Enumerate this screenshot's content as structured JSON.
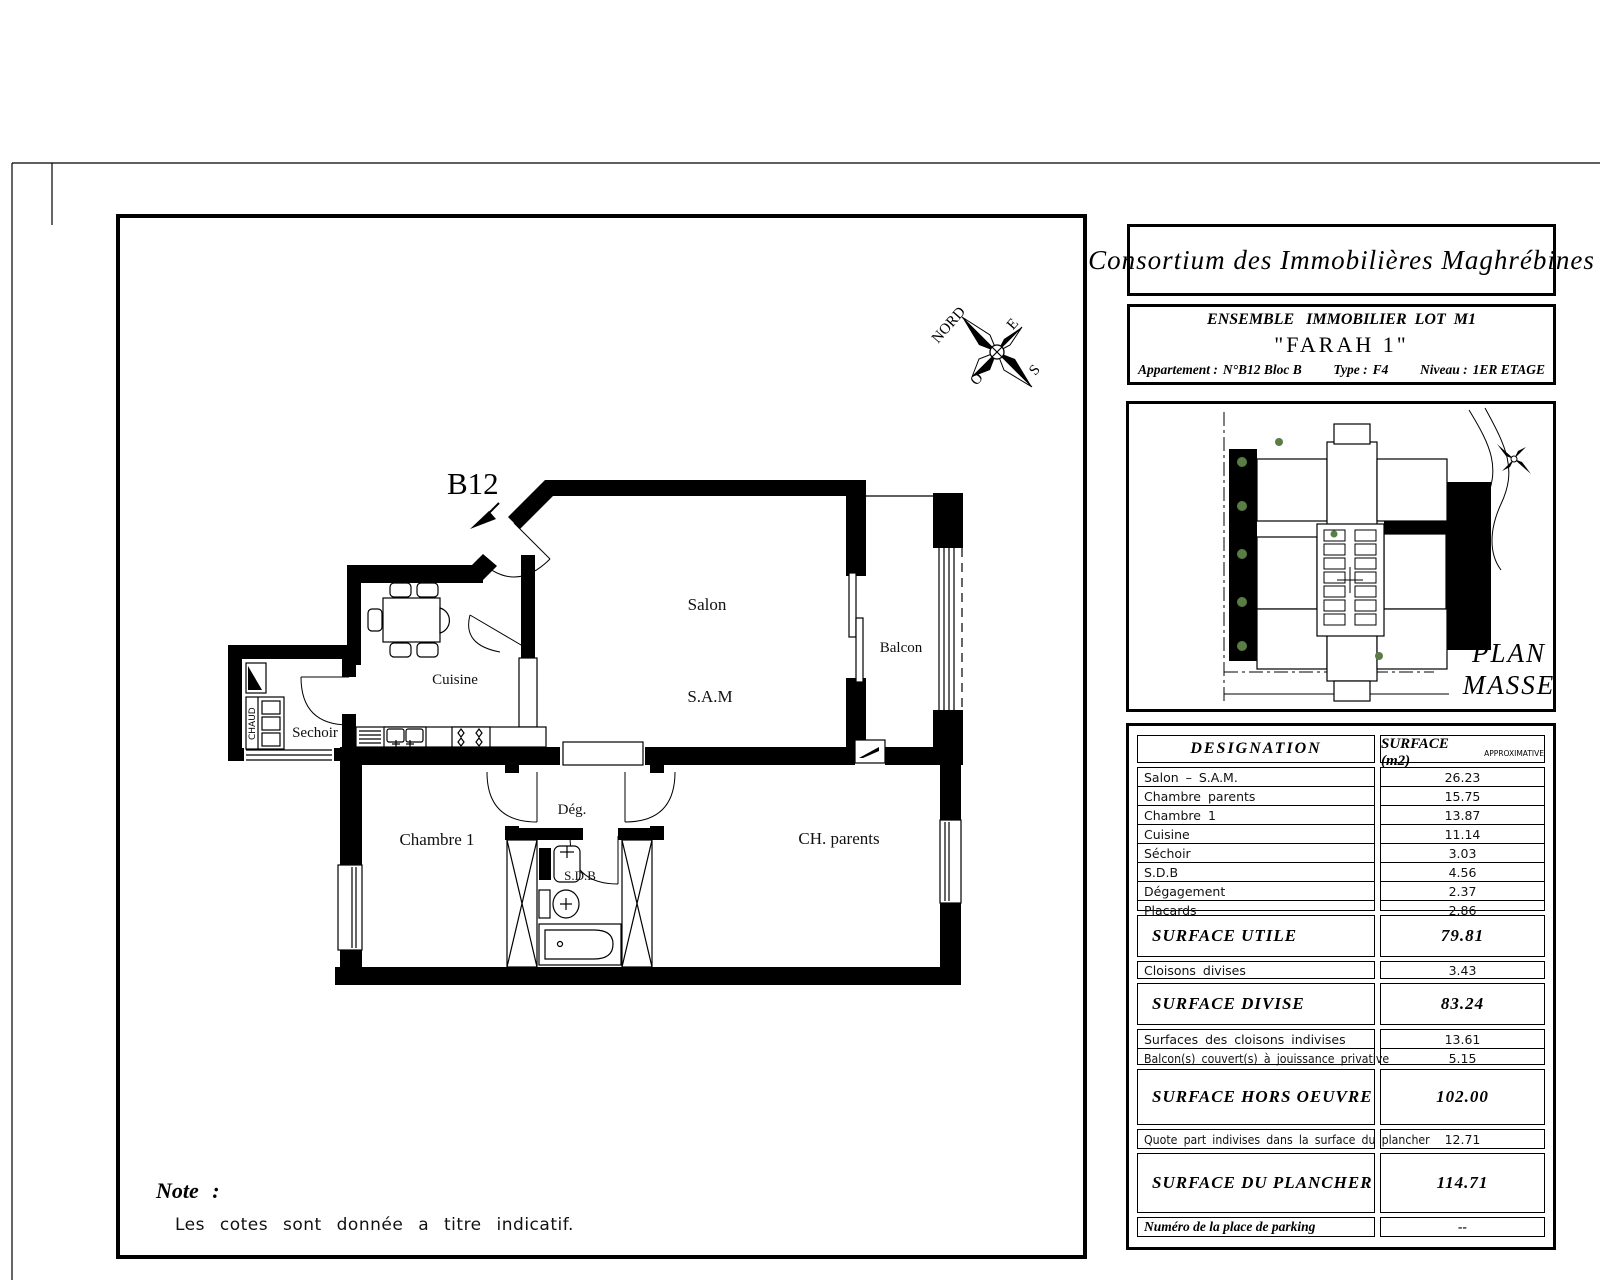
{
  "sheet": {
    "unit_label": "B12",
    "note": {
      "title": "Note :",
      "body": "Les cotes sont donnée a titre indicatif."
    },
    "compass": {
      "n": "NORD",
      "e": "E",
      "w": "O",
      "s": "S"
    },
    "rooms": {
      "salon": "Salon",
      "sam": "S.A.M",
      "balcon": "Balcon",
      "cuisine": "Cuisine",
      "sechoir": "Sechoir",
      "chambre1": "Chambre 1",
      "degagement": "Dég.",
      "sdb": "S.D.B",
      "ch_parents": "CH. parents",
      "chaud": "CHAUD"
    }
  },
  "title_block": {
    "company": "Consortium des Immobilières Maghrébines",
    "project_line1": "ENSEMBLE   IMMOBILIER  LOT  M1",
    "project_line2": "\"FARAH 1\"",
    "apartment_label": "Appartement :",
    "apartment_value": "N°B12 Bloc B",
    "type_label": "Type :",
    "type_value": "F4",
    "level_label": "Niveau :",
    "level_value": "1ER ETAGE"
  },
  "plan_masse": {
    "title_line1": "PLAN",
    "title_line2": "MASSE"
  },
  "surface_table": {
    "header": {
      "designation": "DESIGNATION",
      "surface": "SURFACE (m2)",
      "approx": "APPROXIMATIVE"
    },
    "rooms": [
      {
        "label": "Salon – S.A.M.",
        "value": "26.23"
      },
      {
        "label": "Chambre parents",
        "value": "15.75"
      },
      {
        "label": "Chambre 1",
        "value": "13.87"
      },
      {
        "label": "Cuisine",
        "value": "11.14"
      },
      {
        "label": "Séchoir",
        "value": "3.03"
      },
      {
        "label": "S.D.B",
        "value": "4.56"
      },
      {
        "label": "Dégagement",
        "value": "2.37"
      },
      {
        "label": "Placards",
        "value": "2.86"
      }
    ],
    "surface_utile": {
      "label": "SURFACE UTILE",
      "value": "79.81"
    },
    "cloisons": {
      "label": "Cloisons divises",
      "value": "3.43"
    },
    "surface_divise": {
      "label": "SURFACE DIVISE",
      "value": "83.24"
    },
    "indivises": [
      {
        "label": "Surfaces des cloisons indivises",
        "value": "13.61"
      },
      {
        "label": "Balcon(s) couvert(s) à jouissance privative",
        "value": "5.15"
      }
    ],
    "surface_hors_oeuvre": {
      "label": "SURFACE HORS OEUVRE",
      "value": "102.00"
    },
    "quote_part": {
      "label": "Quote part indivises dans la surface du plancher",
      "value": "12.71"
    },
    "surface_plancher": {
      "label": "SURFACE DU PLANCHER",
      "value": "114.71"
    },
    "parking": {
      "label": "Numéro de la place de parking",
      "value": "--"
    }
  },
  "colors": {
    "wall": "#000000",
    "tree_green": "#5a7d46"
  }
}
